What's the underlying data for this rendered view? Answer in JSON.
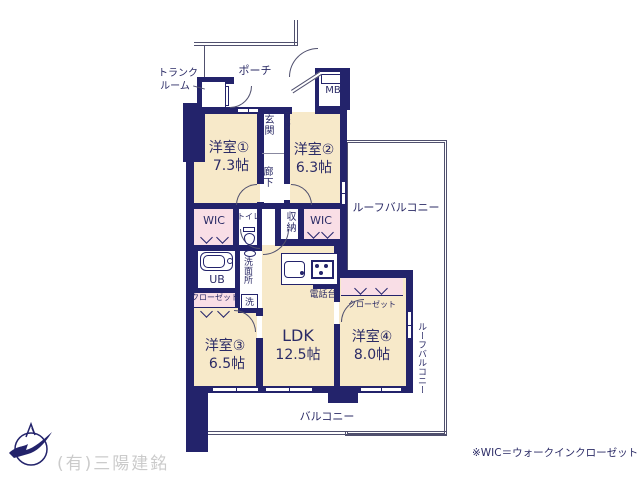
{
  "colors": {
    "wall": "#23236b",
    "line": "#50506e",
    "room": "#f7e9c9",
    "closet": "#f9dee6",
    "text": "#2b2b66",
    "watermark": "#cbcbcb"
  },
  "icons": {
    "compass": "compass-north-icon",
    "bathtub": "bathtub-icon",
    "toilet": "toilet-icon",
    "sink": "kitchen-sink-icon",
    "stove": "stove-icon",
    "basin": "wash-basin-icon"
  },
  "rooms": [
    {
      "name": "洋室①",
      "size": "7.3帖"
    },
    {
      "name": "洋室②",
      "size": "6.3帖"
    },
    {
      "name": "洋室③",
      "size": "6.5帖"
    },
    {
      "name": "洋室④",
      "size": "8.0帖"
    },
    {
      "name": "LDK",
      "size": "12.5帖"
    }
  ],
  "labels": {
    "trunk_l1": "トランク",
    "trunk_l2": "ルーム",
    "porch": "ポーチ",
    "mb": "MB",
    "genkan": "玄関",
    "getabako": "下駄箱",
    "rouka": "廊下",
    "wic": "WIC",
    "toilet": "トイレ",
    "shunou": "収納",
    "ub": "UB",
    "senmenjo": "洗面所",
    "sen": "洗",
    "closet": "クローゼット",
    "denwadai": "電話台",
    "roof_balcony": "ルーフバルコニー",
    "balcony": "バルコニー"
  },
  "footer": {
    "company": "(有)三陽建銘",
    "note": "※WIC＝ウォークインクローゼット"
  }
}
